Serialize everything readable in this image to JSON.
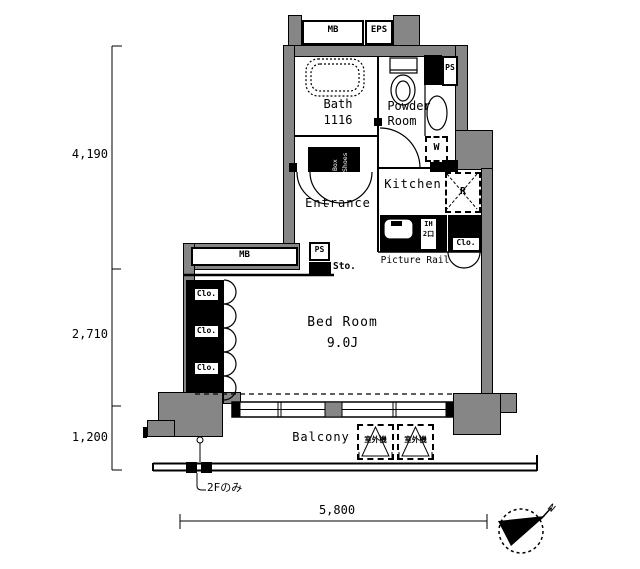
{
  "colors": {
    "wall": "#868686",
    "line": "#000000",
    "bg": "#ffffff"
  },
  "rooms": {
    "bath": {
      "name": "Bath",
      "size": "1116"
    },
    "powder": {
      "line1": "Powder",
      "line2": "Room"
    },
    "kitchen": {
      "name": "Kitchen"
    },
    "entrance": {
      "name": "Entrance"
    },
    "bedroom": {
      "name": "Bed Room",
      "size": "9.0J"
    },
    "balcony": {
      "name": "Balcony"
    }
  },
  "labels": {
    "mb_meter_box": "MB",
    "eps": "EPS",
    "ps_upper": "PS",
    "ps_hall": "PS",
    "mb_window": "MB",
    "storage": "Sto.",
    "shoes_line1": "Shoes",
    "shoes_line2": "Box",
    "washing_machine": "W",
    "refrigerator": "R",
    "stove_line1": "IH",
    "stove_line2": "2口",
    "picture_rail": "Picture Rail",
    "closet_kitchen": "Clo.",
    "closets_bedroom": [
      "Clo.",
      "Clo.",
      "Clo."
    ],
    "outdoor_units": [
      "室外機",
      "室外機"
    ],
    "floor_note": "2Fのみ",
    "north": "N"
  },
  "dimensions": {
    "left": [
      "4,190",
      "2,710",
      "1,200"
    ],
    "bottom": "5,800"
  }
}
